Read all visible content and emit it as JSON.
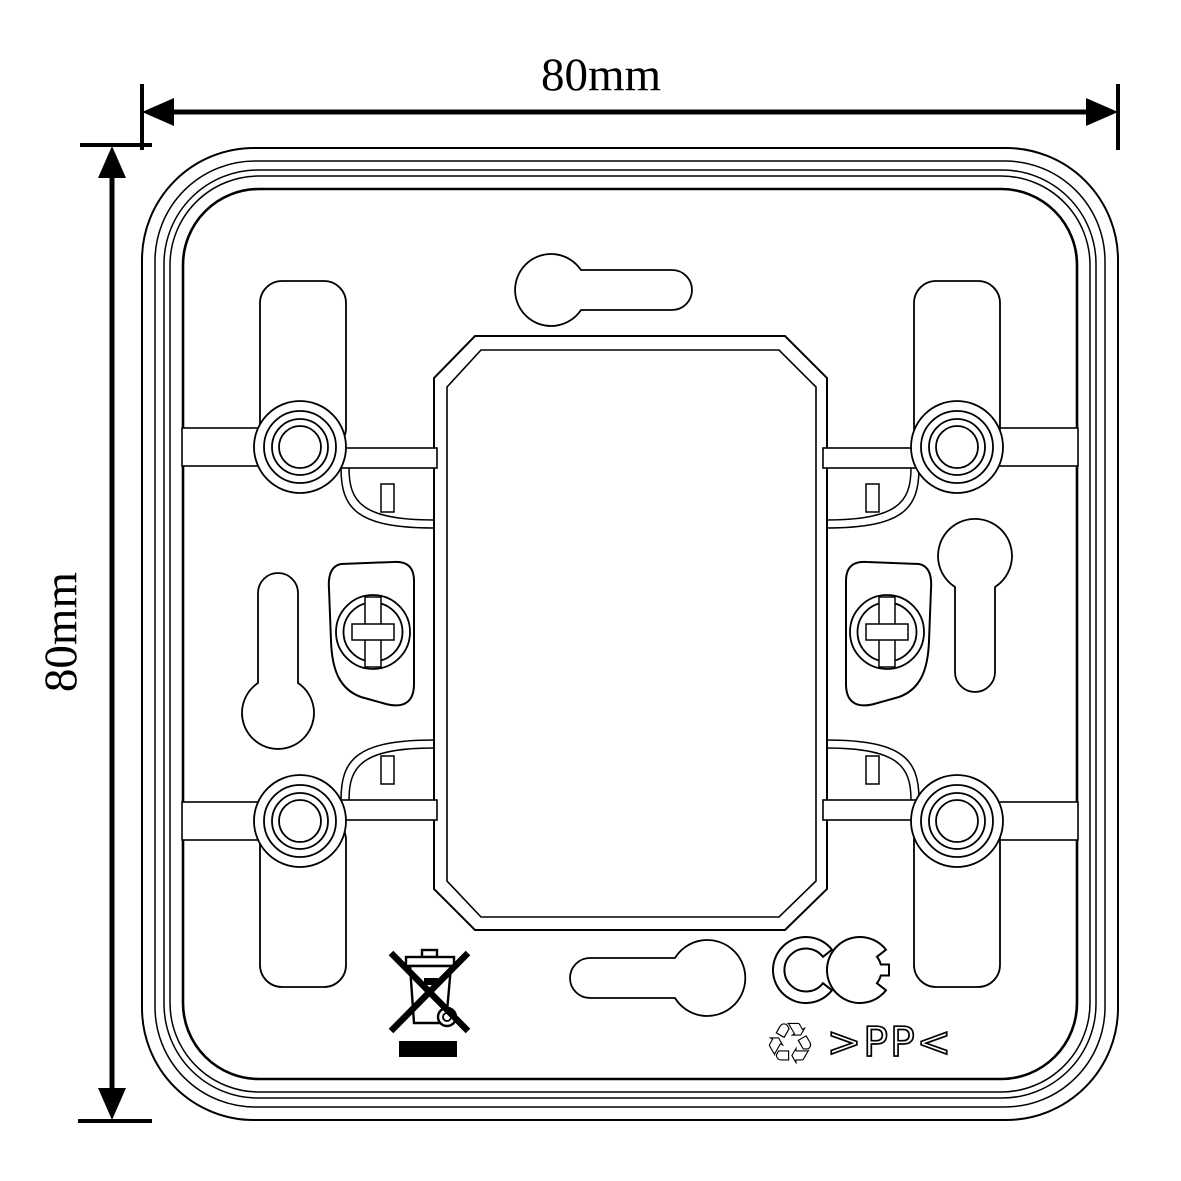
{
  "page": {
    "background": "#ffffff",
    "line_color": "#000000"
  },
  "drawing": {
    "subject": "square-mounting-plate",
    "dimension_width": {
      "label": "80mm"
    },
    "dimension_height": {
      "label": "80mm"
    },
    "markings": {
      "material_code": ">PP<",
      "recycling_symbol": "♲",
      "ce_mark": "CE",
      "weee_symbol": "crossed-out-wheelie-bin"
    }
  }
}
